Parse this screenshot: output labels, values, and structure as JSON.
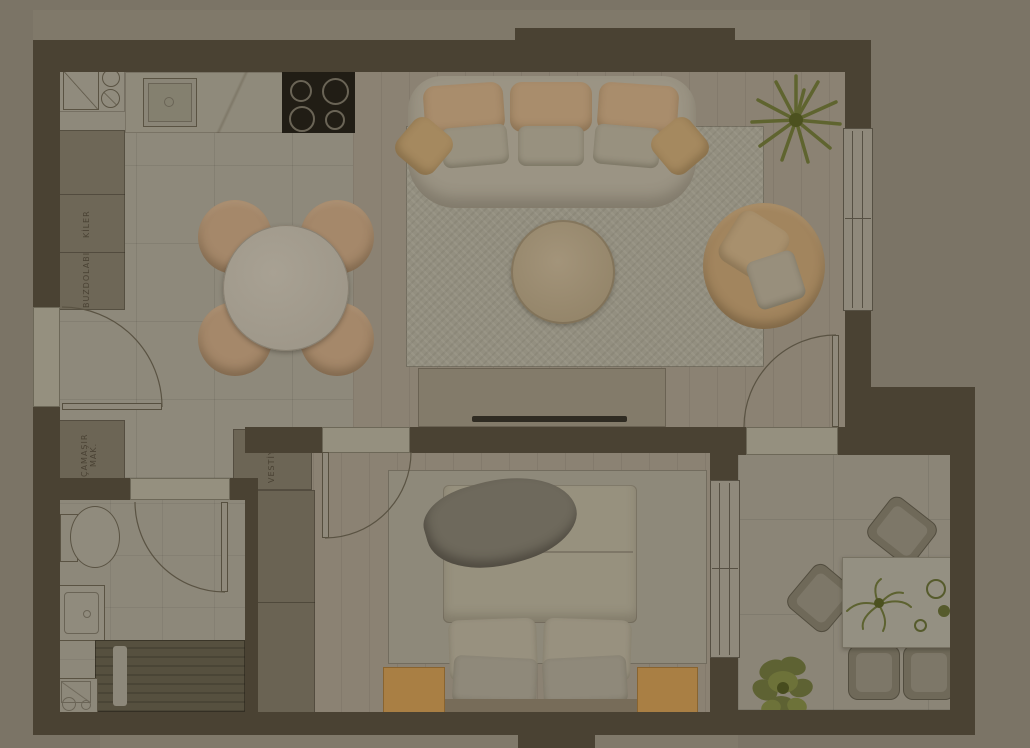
{
  "palette": {
    "exterior_background": "#7b7466",
    "exterior_band": "#80796a",
    "wall": "#4a4233",
    "tile_floor": "#8e897b",
    "wood_floor": "#8b8273",
    "rug": "#938f80",
    "closet": "#6c6555",
    "sofa_tan": "#a98d6c",
    "pillow_white": "#98917f",
    "stove_black": "#211d15",
    "nightstand_orange": "#a97f44",
    "plant_green": "#666c35",
    "label_text": "#4a4234"
  },
  "floor_plan": {
    "view": "top-down apartment floor plan, dimmed",
    "labels": {
      "pantry": "KİLER",
      "refrigerator": "BUZDOLABI",
      "washing_machine": "ÇAMAŞIR MAK.",
      "coat_closet": "VESTİYER"
    },
    "rooms": [
      "kitchen-dining",
      "living-room",
      "bedroom",
      "bathroom",
      "balcony",
      "entry-hall"
    ],
    "furniture": {
      "kitchen": [
        "appliance-unit",
        "sink",
        "cooktop-4-burners",
        "counter",
        "tall-cabinet",
        "dining-table-round",
        "4-dining-chairs"
      ],
      "living": [
        "3-seat-sofa",
        "area-rug",
        "round-coffee-table",
        "armchair",
        "potted-plant",
        "tv-unit"
      ],
      "bedroom": [
        "double-bed",
        "2-nightstands",
        "wardrobe",
        "area-rug"
      ],
      "bathroom": [
        "toilet",
        "washbasin",
        "shower"
      ],
      "balcony": [
        "outdoor-table",
        "4-outdoor-chairs",
        "potted-plant",
        "table-plant"
      ]
    },
    "doors": [
      "entrance-door",
      "bathroom-door",
      "bedroom-door",
      "balcony-door"
    ],
    "windows": [
      "living-room-window",
      "bedroom-window"
    ]
  }
}
